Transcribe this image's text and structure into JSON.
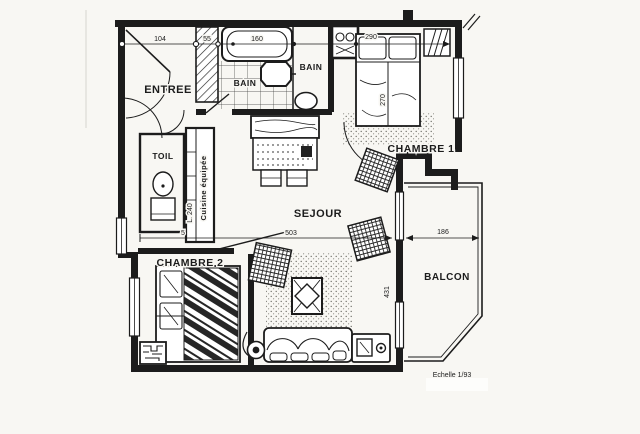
{
  "plan": {
    "labels": {
      "entree": "ENTREE",
      "bain_left": "BAIN",
      "bain_right": "BAIN",
      "toil": "TOIL",
      "cuisine": "Cuisine équipée",
      "chambre1": "CHAMBRE 1",
      "chambre2": "CHAMBRE 2",
      "sejour": "SEJOUR",
      "balcon": "BALCON"
    },
    "dimensions": {
      "entree_width": "104",
      "placard_width": "55",
      "baignoire_length": "160",
      "chambre1_width": "290",
      "chambre1_depth": "270",
      "cuisine_length": "L. 240",
      "cuisine_clearance": "5",
      "sejour_width": "503",
      "sejour_depth": "431",
      "balcon_width": "186"
    },
    "scale": "Echelle 1/93",
    "colors": {
      "ink": "#1c1c1c",
      "paper": "#f8f7f3"
    }
  }
}
